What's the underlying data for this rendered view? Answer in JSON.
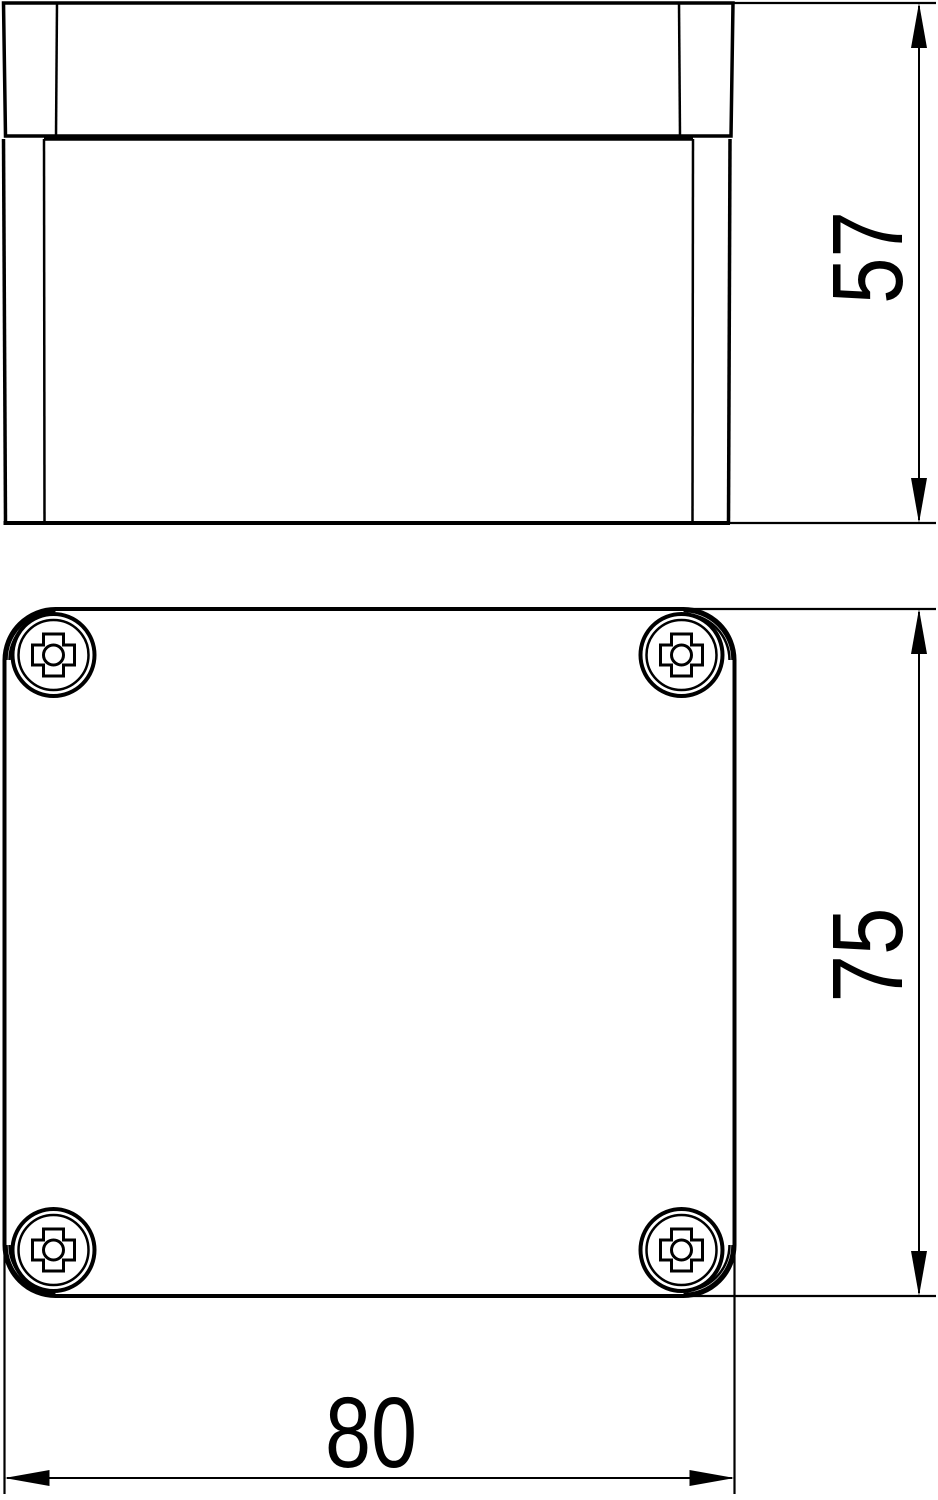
{
  "canvas": {
    "width": 938,
    "height": 1500,
    "background_color": "#ffffff",
    "line_color": "#000000"
  },
  "drawing": {
    "kind": "technical-dimension-drawing",
    "views": {
      "side": {
        "description": "side elevation of enclosure with lid",
        "height_dimension": "57"
      },
      "top": {
        "description": "plan view of enclosure lid with corner screws",
        "height_dimension": "75",
        "width_dimension": "80",
        "screw_count": 4,
        "screw_type": "phillips-screw"
      }
    }
  }
}
